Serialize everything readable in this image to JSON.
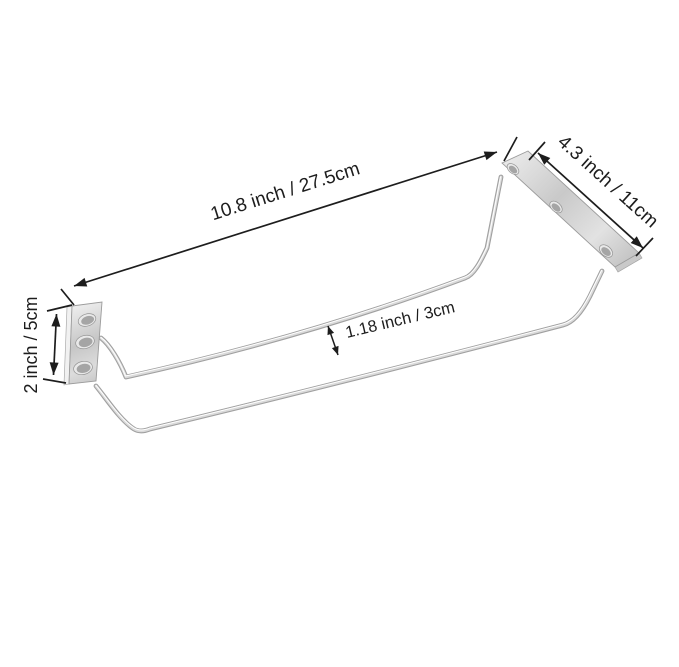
{
  "image": {
    "kind": "product dimension diagram",
    "subject": "wall-mounted wire stemware / wine glass rack with two mounting plates",
    "background_color": "#ffffff",
    "annotation_color": "#1d1d1d",
    "metal_light": "#ededed",
    "metal_mid": "#c6c6c6",
    "metal_dark": "#9b9b9b"
  },
  "dimensions": {
    "overall_length": "10.8 inch / 27.5cm",
    "bracket_length": "4.3 inch / 11cm",
    "bracket_height": "2 inch / 5cm",
    "rail_gap": "1.18 inch / 3cm"
  }
}
